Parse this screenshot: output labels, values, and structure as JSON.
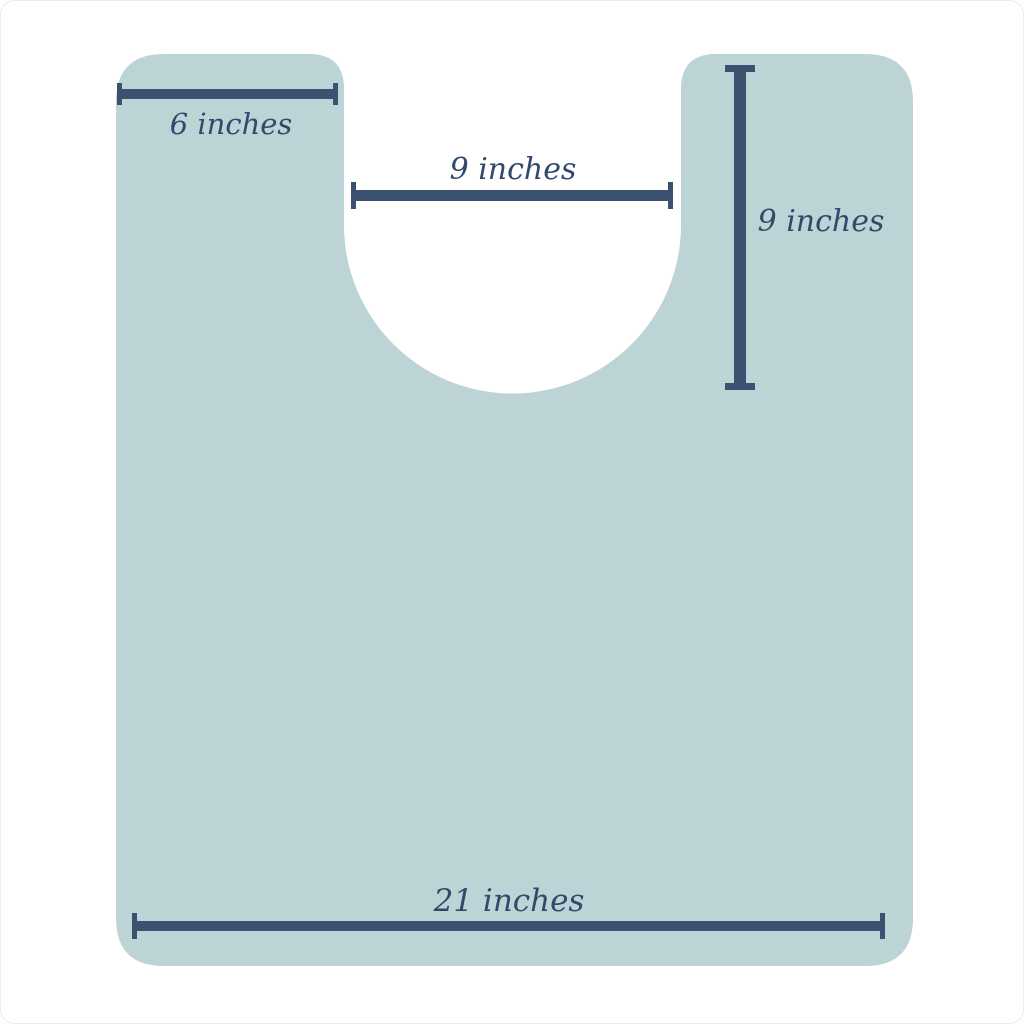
{
  "diagram": {
    "name": "contour-mat-dimension-diagram",
    "description": "Contour bath mat outline with U-shaped cutout and four dimension callouts",
    "colors": {
      "mat_fill": "#bcd4d6",
      "dim_line": "#3a5170",
      "dim_text": "#33496b",
      "background": "#ffffff"
    },
    "dimensions": [
      {
        "id": "top-left-width",
        "label": "6 inches",
        "orientation": "horizontal",
        "value_inches": 6
      },
      {
        "id": "cutout-width",
        "label": "9 inches",
        "orientation": "horizontal",
        "value_inches": 9
      },
      {
        "id": "cutout-depth",
        "label": "9 inches",
        "orientation": "vertical",
        "value_inches": 9
      },
      {
        "id": "bottom-width",
        "label": "21 inches",
        "orientation": "horizontal",
        "value_inches": 21
      }
    ]
  }
}
